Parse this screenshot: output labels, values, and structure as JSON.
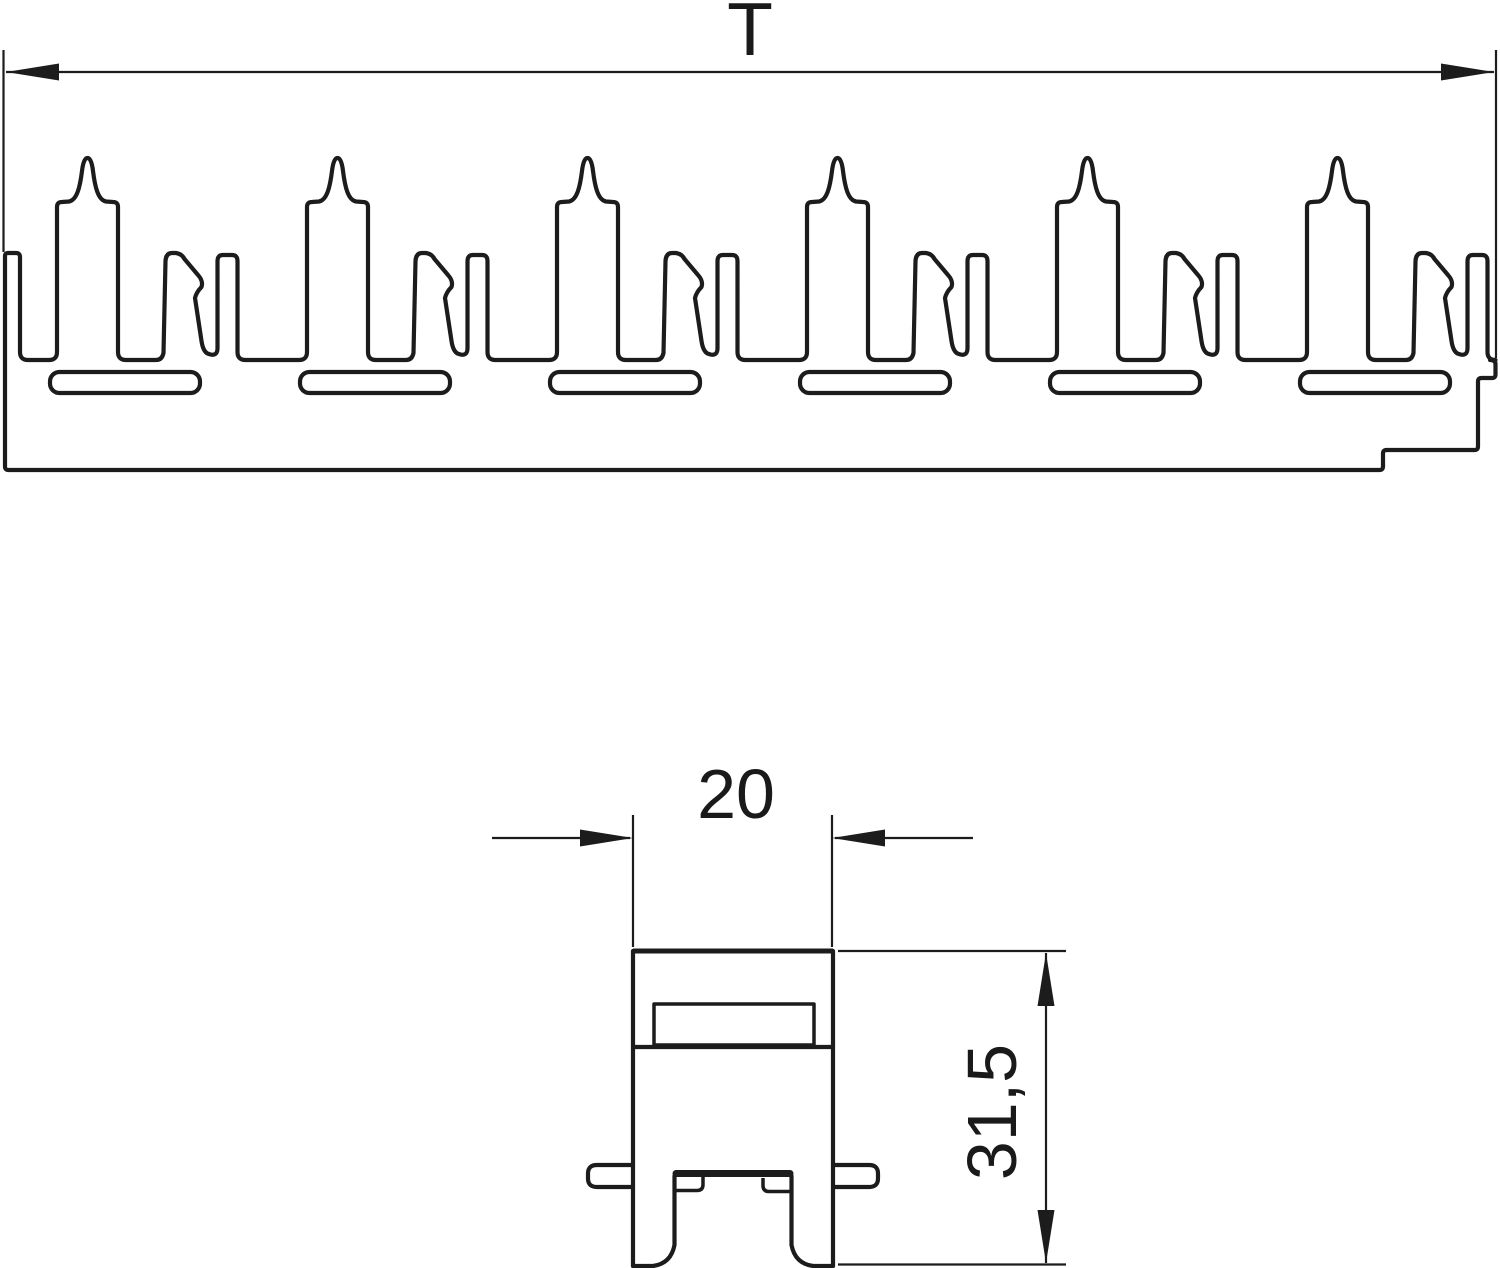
{
  "page": {
    "background": "#ffffff",
    "line_color": "#1c1c1c",
    "kind": "technical-dimension-drawing"
  },
  "drawing": {
    "top_view": {
      "name": "clamp-strip-profile-section",
      "clip_count": 6,
      "clip_pitch_px": 250,
      "slot_count": 6,
      "width_dimension": {
        "label": "T"
      }
    },
    "front_view": {
      "name": "single-clamp-front",
      "width_dimension": {
        "label": "20"
      },
      "height_dimension": {
        "label": "31,5"
      }
    }
  }
}
